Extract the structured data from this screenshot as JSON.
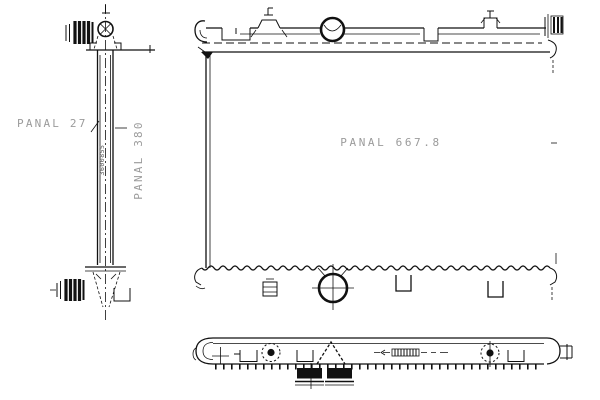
{
  "labels": {
    "side_depth": "PANAL 27",
    "side_height": "PANAL 380",
    "side_code": "3600855",
    "front_width": "PANAL 667.8"
  },
  "colors": {
    "line": "#111111",
    "dimension_text": "#9b9b9b",
    "background": "#ffffff"
  }
}
